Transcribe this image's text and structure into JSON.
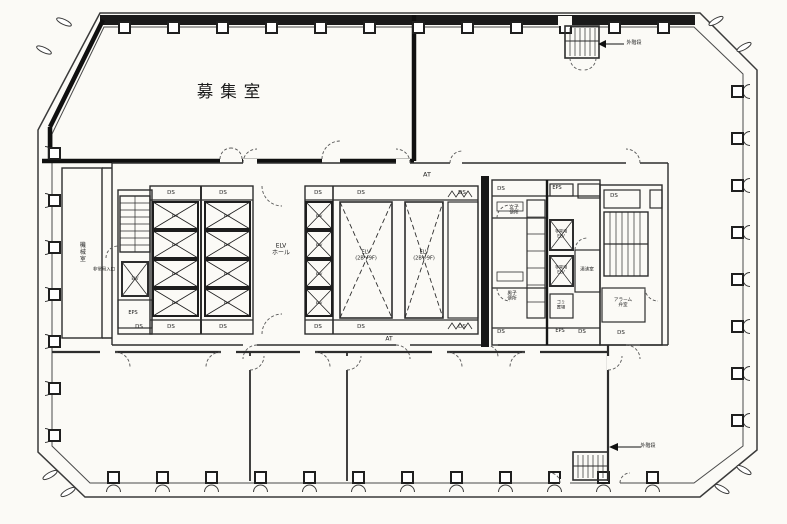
{
  "plan": {
    "type": "floor-plan",
    "main_room": "募集室",
    "labels": [
      {
        "id": "room-title",
        "text": "募集室",
        "x": 232,
        "y": 92,
        "s": 16.5,
        "ls": 7
      },
      {
        "id": "at-label-top",
        "text": "AT",
        "x": 427,
        "y": 175,
        "s": 6.5
      },
      {
        "id": "at-label-bottom",
        "text": "AT",
        "x": 389,
        "y": 340,
        "s": 6
      },
      {
        "id": "ds-label",
        "text": "DS",
        "x": 171,
        "y": 193,
        "s": 5.5
      },
      {
        "id": "ds-label",
        "text": "DS",
        "x": 223,
        "y": 193,
        "s": 5.5
      },
      {
        "id": "ds-label",
        "text": "DS",
        "x": 171,
        "y": 327,
        "s": 5.5
      },
      {
        "id": "ds-label",
        "text": "DS",
        "x": 223,
        "y": 327,
        "s": 5.5
      },
      {
        "id": "ds-label",
        "text": "DS",
        "x": 318,
        "y": 193,
        "s": 5.5
      },
      {
        "id": "ds-label",
        "text": "DS",
        "x": 361,
        "y": 193,
        "s": 5.5
      },
      {
        "id": "ds-label",
        "text": "DS",
        "x": 462,
        "y": 193,
        "s": 5.5
      },
      {
        "id": "ds-label",
        "text": "DS",
        "x": 318,
        "y": 327,
        "s": 5.5
      },
      {
        "id": "ds-label",
        "text": "DS",
        "x": 361,
        "y": 327,
        "s": 5.5
      },
      {
        "id": "ds-label",
        "text": "DS",
        "x": 462,
        "y": 327,
        "s": 5.5
      },
      {
        "id": "ds-label",
        "text": "DS",
        "x": 139,
        "y": 327,
        "s": 5.5
      },
      {
        "id": "ds-label",
        "text": "DS",
        "x": 501,
        "y": 189,
        "s": 5.5
      },
      {
        "id": "ds-label",
        "text": "DS",
        "x": 501,
        "y": 332,
        "s": 5.5
      },
      {
        "id": "ds-label",
        "text": "DS",
        "x": 582,
        "y": 332,
        "s": 5.5
      },
      {
        "id": "ds-label",
        "text": "DS",
        "x": 614,
        "y": 196,
        "s": 5.5
      },
      {
        "id": "ds-label",
        "text": "DS",
        "x": 621,
        "y": 333,
        "s": 5.5
      },
      {
        "id": "eps-label",
        "text": "EPS",
        "x": 133,
        "y": 314,
        "s": 5
      },
      {
        "id": "eps-label",
        "text": "EPS",
        "x": 557,
        "y": 189,
        "s": 5
      },
      {
        "id": "eps-label",
        "text": "EPS",
        "x": 560,
        "y": 332,
        "s": 5
      },
      {
        "id": "elv-hall-label",
        "text": "ELV\nホール",
        "x": 281,
        "y": 250,
        "s": 6
      },
      {
        "id": "future-shaft-label",
        "text": "ELV\n(2B〜9F)",
        "x": 366,
        "y": 256,
        "s": 5
      },
      {
        "id": "future-shaft-label",
        "text": "ELV\n(2B〜9F)",
        "x": 424,
        "y": 256,
        "s": 5
      },
      {
        "id": "elv-car-label",
        "text": "ELV",
        "x": 175,
        "y": 216,
        "s": 3.8
      },
      {
        "id": "elv-car-label",
        "text": "ELV",
        "x": 175,
        "y": 245,
        "s": 3.8
      },
      {
        "id": "elv-car-label",
        "text": "ELV",
        "x": 175,
        "y": 274,
        "s": 3.8
      },
      {
        "id": "elv-car-label",
        "text": "ELV",
        "x": 175,
        "y": 303,
        "s": 3.8
      },
      {
        "id": "elv-car-label",
        "text": "ELV",
        "x": 227,
        "y": 216,
        "s": 3.8
      },
      {
        "id": "elv-car-label",
        "text": "ELV",
        "x": 227,
        "y": 245,
        "s": 3.8
      },
      {
        "id": "elv-car-label",
        "text": "ELV",
        "x": 227,
        "y": 274,
        "s": 3.8
      },
      {
        "id": "elv-car-label",
        "text": "ELV",
        "x": 227,
        "y": 303,
        "s": 3.8
      },
      {
        "id": "elv-car-label",
        "text": "ELV",
        "x": 319,
        "y": 216,
        "s": 3.8
      },
      {
        "id": "elv-car-label",
        "text": "ELV",
        "x": 319,
        "y": 245,
        "s": 3.8
      },
      {
        "id": "elv-car-label",
        "text": "ELV",
        "x": 319,
        "y": 274,
        "s": 3.8
      },
      {
        "id": "elv-car-label",
        "text": "ELV",
        "x": 319,
        "y": 303,
        "s": 3.8
      },
      {
        "id": "elv-car-label",
        "text": "ELV",
        "x": 135,
        "y": 279,
        "s": 4
      },
      {
        "id": "womens-toilet-label",
        "text": "女子\n便所",
        "x": 514,
        "y": 211,
        "s": 4.8
      },
      {
        "id": "mens-toilet-label",
        "text": "男子\n便所",
        "x": 512,
        "y": 297,
        "s": 4.8
      },
      {
        "id": "emergency-elv-label",
        "text": "非常用\nELV",
        "x": 561,
        "y": 234,
        "s": 4.2
      },
      {
        "id": "emergency-elv-label",
        "text": "非常用\nELV",
        "x": 561,
        "y": 270,
        "s": 4.2
      },
      {
        "id": "garbage-label",
        "text": "ゴミ\n置場",
        "x": 561,
        "y": 305,
        "s": 4.2
      },
      {
        "id": "hot-water-label",
        "text": "湯沸室",
        "x": 587,
        "y": 270,
        "s": 4.6
      },
      {
        "id": "alarm-valve-label",
        "text": "アラーム\n弁室",
        "x": 623,
        "y": 303,
        "s": 4.6
      },
      {
        "id": "machine-room-label",
        "text": "機械室",
        "x": 81,
        "y": 252,
        "s": 6,
        "rot": "v"
      },
      {
        "id": "emergency-entrance-label",
        "text": "非常用入口",
        "x": 104,
        "y": 271,
        "s": 4.4
      },
      {
        "id": "ext-stair-label",
        "text": "外階段",
        "x": 634,
        "y": 44,
        "s": 5
      },
      {
        "id": "ext-stair-label",
        "text": "外階段",
        "x": 648,
        "y": 447,
        "s": 5
      }
    ]
  },
  "colors": {
    "paper": "#fbfaf6",
    "line": "#2d2d2d",
    "heavy_wall": "#161616",
    "text": "#1a1a1a"
  }
}
